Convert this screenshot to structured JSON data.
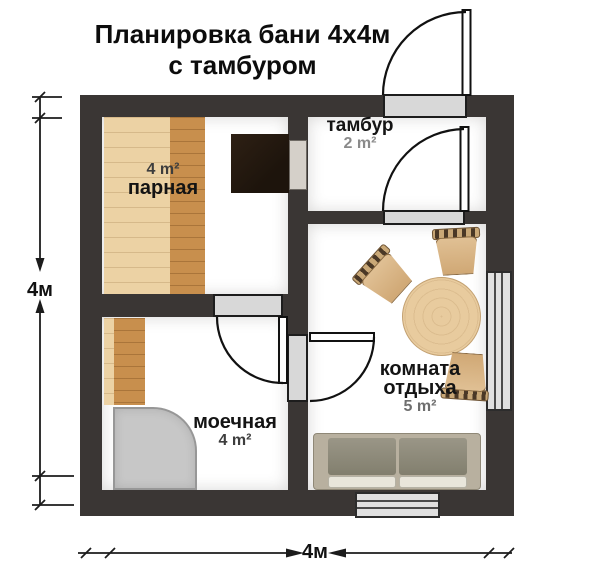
{
  "title": {
    "line1": "Планировка бани 4х4м",
    "line2": "с тамбуром"
  },
  "rooms": {
    "parnaya": {
      "name": "парная",
      "area": "4 m²"
    },
    "tambur": {
      "name": "тамбур",
      "area": "2 m²"
    },
    "moechnaya": {
      "name": "моечная",
      "area": "4 m²"
    },
    "rest": {
      "name_line1": "комната",
      "name_line2": "отдыха",
      "area": "5 m²"
    }
  },
  "stove": {
    "label": "печь"
  },
  "dimensions": {
    "left": "4м",
    "bottom": "4м"
  },
  "colors": {
    "wall": "#3a3634",
    "floor": "#ffffff",
    "opening": "#d8d8d8",
    "wood_light": "#ecd2a4",
    "wood_dark": "#c88f4d",
    "stove": "#221911",
    "shower": "#c7c7c7",
    "table": "#e8cb9e",
    "sofa_frame": "#b8b09f",
    "sofa_back_cushion": "#8f8c7d",
    "sofa_seat_cushion": "#e9e6db",
    "window": "#e0e0e0"
  }
}
